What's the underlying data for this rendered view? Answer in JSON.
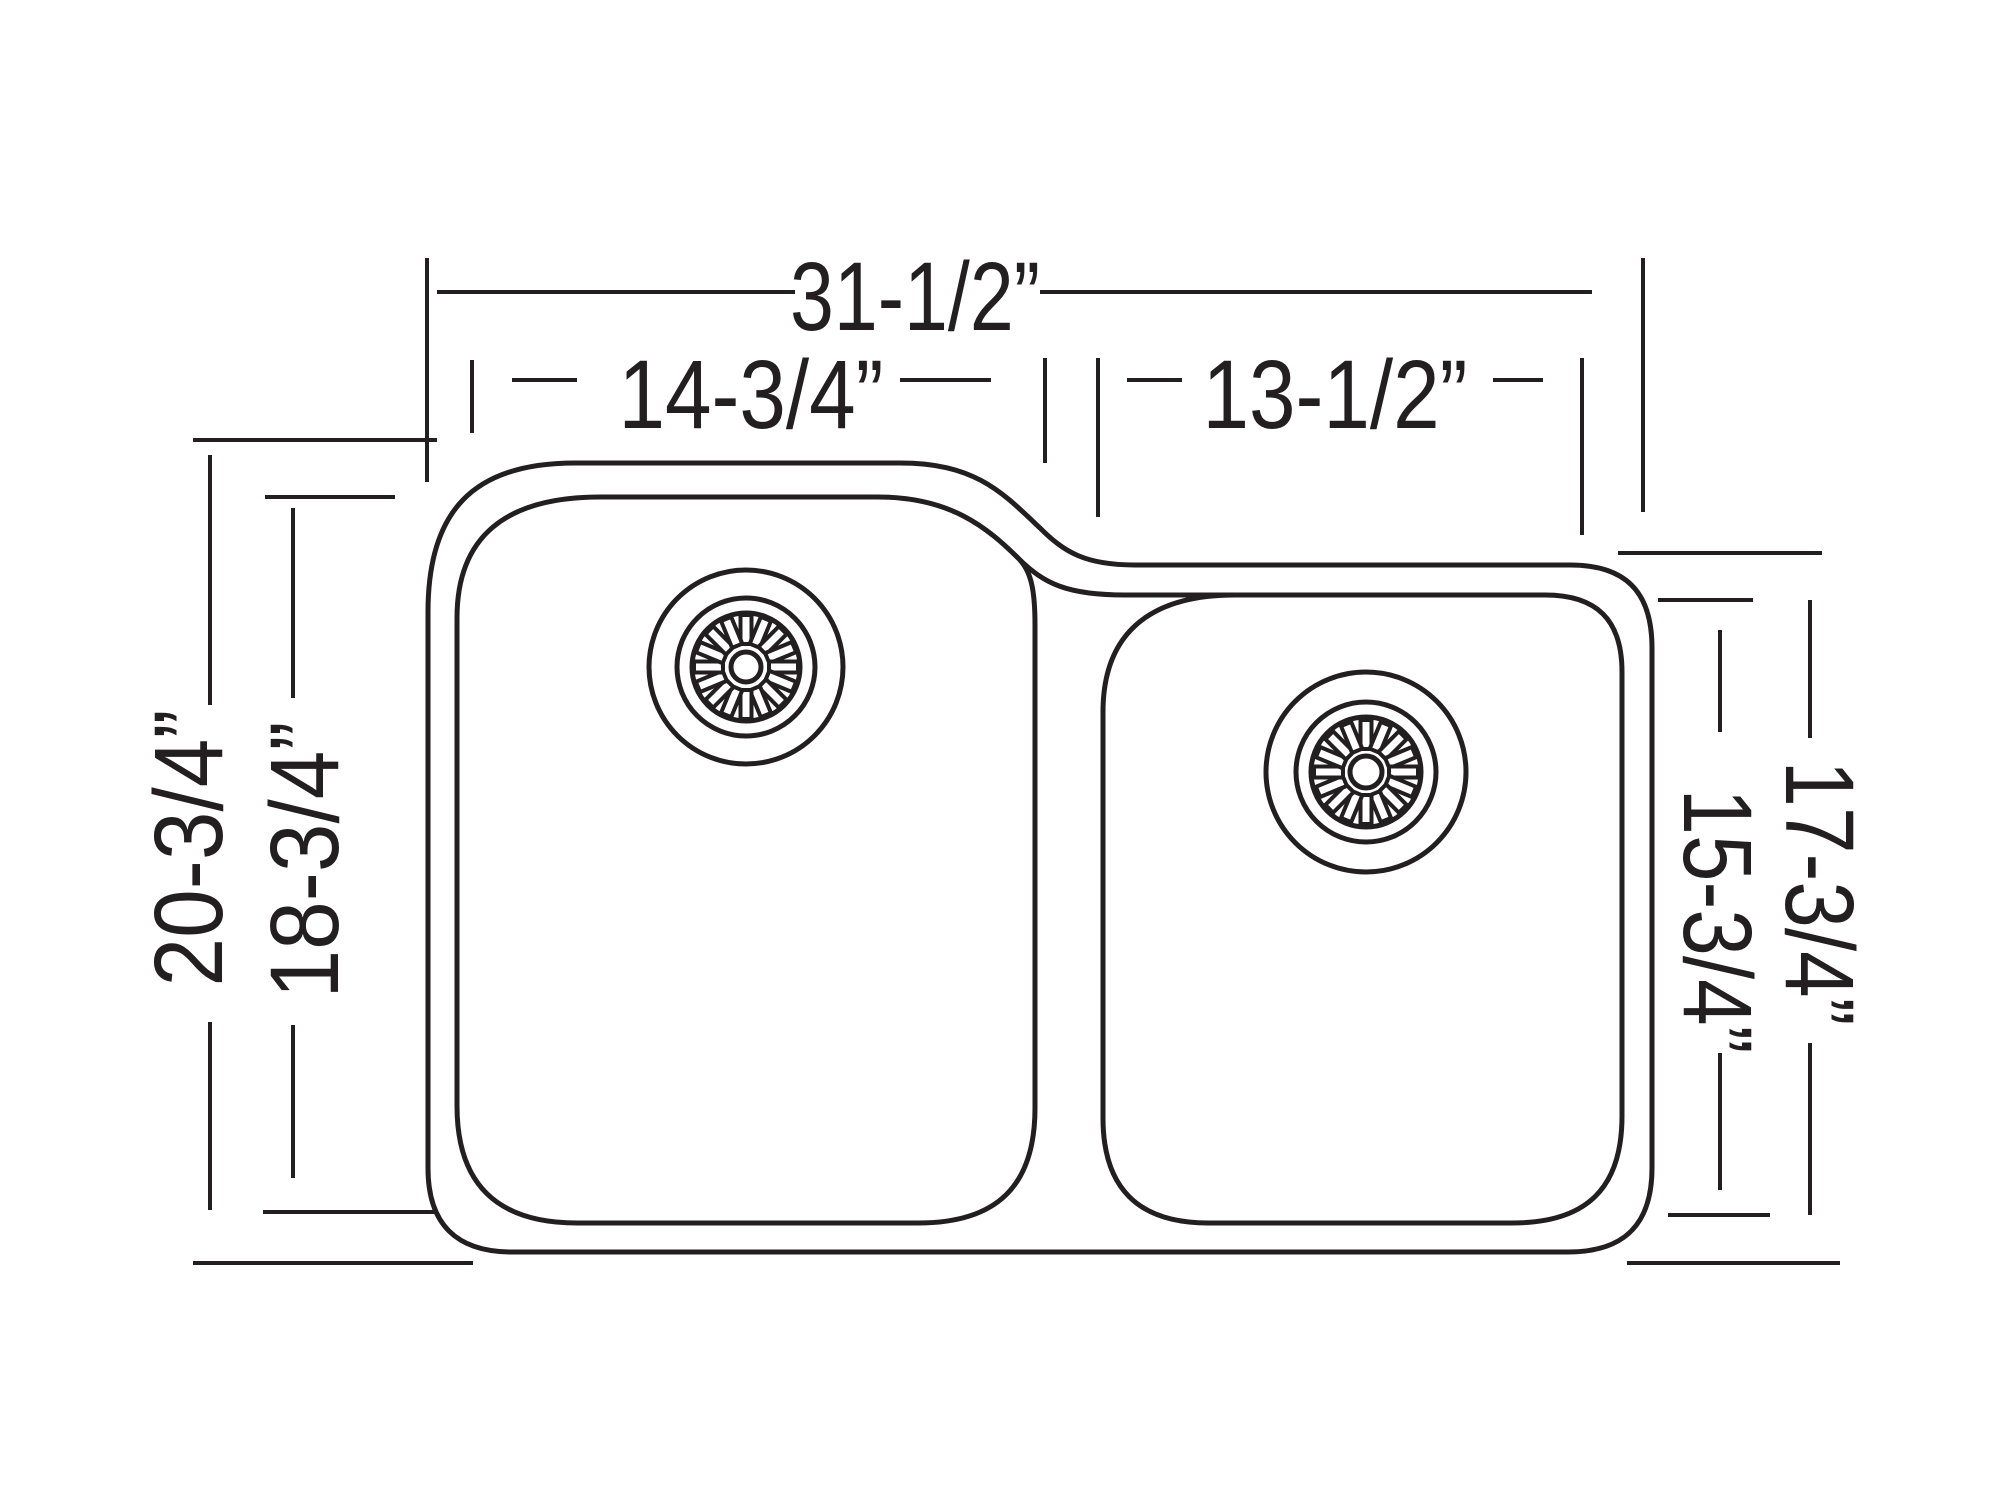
{
  "diagram": {
    "title": "double-bowl-undermount-sink-dimension-drawing",
    "units": "inches",
    "line_color": "#231f20",
    "background_color": "#ffffff",
    "dimensions": {
      "overall_width": {
        "label": "31-1/2”",
        "value": 31.5,
        "measures": "overall sink width"
      },
      "left_bowl_width": {
        "label": "14-3/4”",
        "value": 14.75,
        "measures": "left bowl interior width"
      },
      "right_bowl_width": {
        "label": "13-1/2”",
        "value": 13.5,
        "measures": "right bowl interior width"
      },
      "left_outer_depth": {
        "label": "20-3/4”",
        "value": 20.75,
        "measures": "left section outer front-to-back"
      },
      "left_bowl_depth": {
        "label": "18-3/4”",
        "value": 18.75,
        "measures": "left bowl interior front-to-back"
      },
      "right_outer_depth": {
        "label": "17-3/4”",
        "value": 17.75,
        "measures": "right section outer front-to-back"
      },
      "right_bowl_depth": {
        "label": "15-3/4”",
        "value": 15.75,
        "measures": "right bowl interior front-to-back"
      }
    },
    "features": {
      "left_drain": "sunburst strainer drain, upper-right of left bowl",
      "right_drain": "sunburst strainer drain, upper-center of right bowl"
    }
  }
}
